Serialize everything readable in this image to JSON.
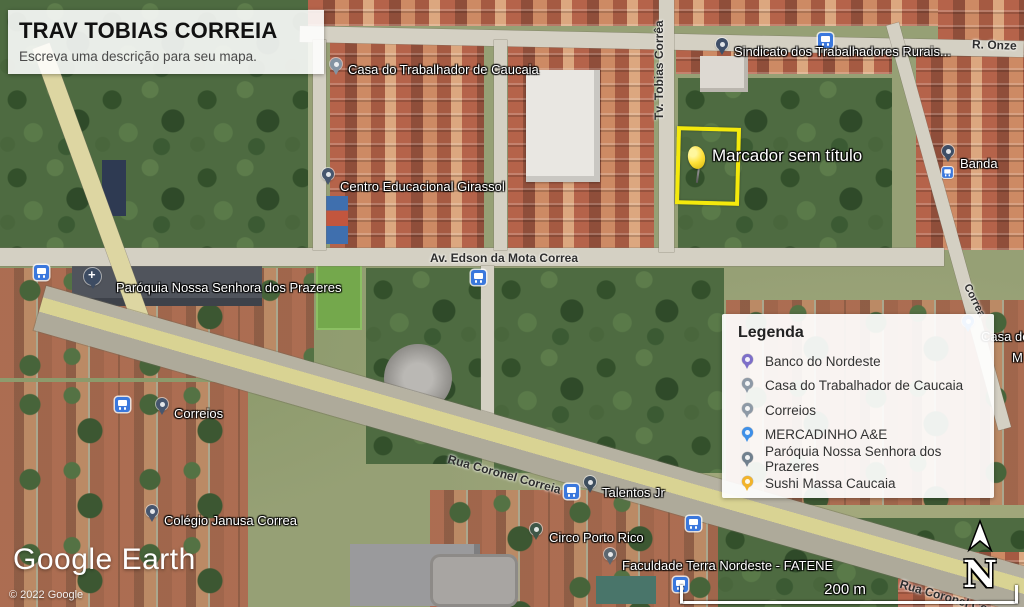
{
  "title_card": {
    "title": "TRAV TOBIAS CORREIA",
    "subtitle": "Escreva uma descrição para seu mapa."
  },
  "marker": {
    "label": "Marcador sem título",
    "outline_color": "#f4e90c",
    "pin_color": "#ffe13a"
  },
  "legend": {
    "heading": "Legenda",
    "items": [
      {
        "label": "Banco do Nordeste",
        "color": "#7d6fc9"
      },
      {
        "label": "Casa do Trabalhador de Caucaia",
        "color": "#8d99a6"
      },
      {
        "label": "Correios",
        "color": "#8d99a6"
      },
      {
        "label": "MERCADINHO A&E",
        "color": "#3d8fe8"
      },
      {
        "label": "Paróquia Nossa Senhora dos Prazeres",
        "color": "#70808e"
      },
      {
        "label": "Sushi Massa Caucaia",
        "color": "#f2b32a"
      }
    ]
  },
  "places": {
    "casa_trabalhador": {
      "label": "Casa do Trabalhador de Caucaia",
      "color": "#8494a3"
    },
    "sindicato": {
      "label": "Sindicato dos Trabalhadores Rurais...",
      "color": "#3f4f68"
    },
    "girassol": {
      "label": "Centro Educacional Girassol",
      "color": "#46566e"
    },
    "paroquia": {
      "label": "Paróquia Nossa Senhora dos Prazeres",
      "color": "#3d4c63"
    },
    "correios": {
      "label": "Correios",
      "color": "#46566e"
    },
    "colegio": {
      "label": "Colégio Janusa Correa",
      "color": "#46566e"
    },
    "talentos": {
      "label": "Talentos Jr",
      "color": "#3e4e5e"
    },
    "circo": {
      "label": "Circo Porto Rico",
      "color": "#3e5647"
    },
    "fatene": {
      "label": "Faculdade Terra Nordeste - FATENE",
      "color": "#5d6770"
    },
    "banda": {
      "label": "Banda",
      "color": "#3e4e66"
    },
    "casa_de": {
      "label": "Casa de",
      "color": "#3d8fe8"
    },
    "mercadinho_fragment": {
      "label": "M"
    }
  },
  "streets": {
    "tobias": "Tv. Tobias Corrêa",
    "edson": "Av. Edson da Mota Correa",
    "coronel": "Rua Coronel Correia",
    "onze": "R. Onze",
    "right_fragment": "Correa"
  },
  "attribution": {
    "logo": "Google Earth",
    "copyright": "© 2022 Google"
  },
  "scale_bar": {
    "label": "200 m"
  },
  "compass": {
    "label": "N"
  },
  "icons": {
    "bus_stop": "blue rounded square with white bus",
    "place_pin": "teardrop map pin with white center",
    "church": "dark pin with white cross",
    "pushpin": "yellow pushpin marker",
    "north_arrow": "white arrow above letter N"
  }
}
